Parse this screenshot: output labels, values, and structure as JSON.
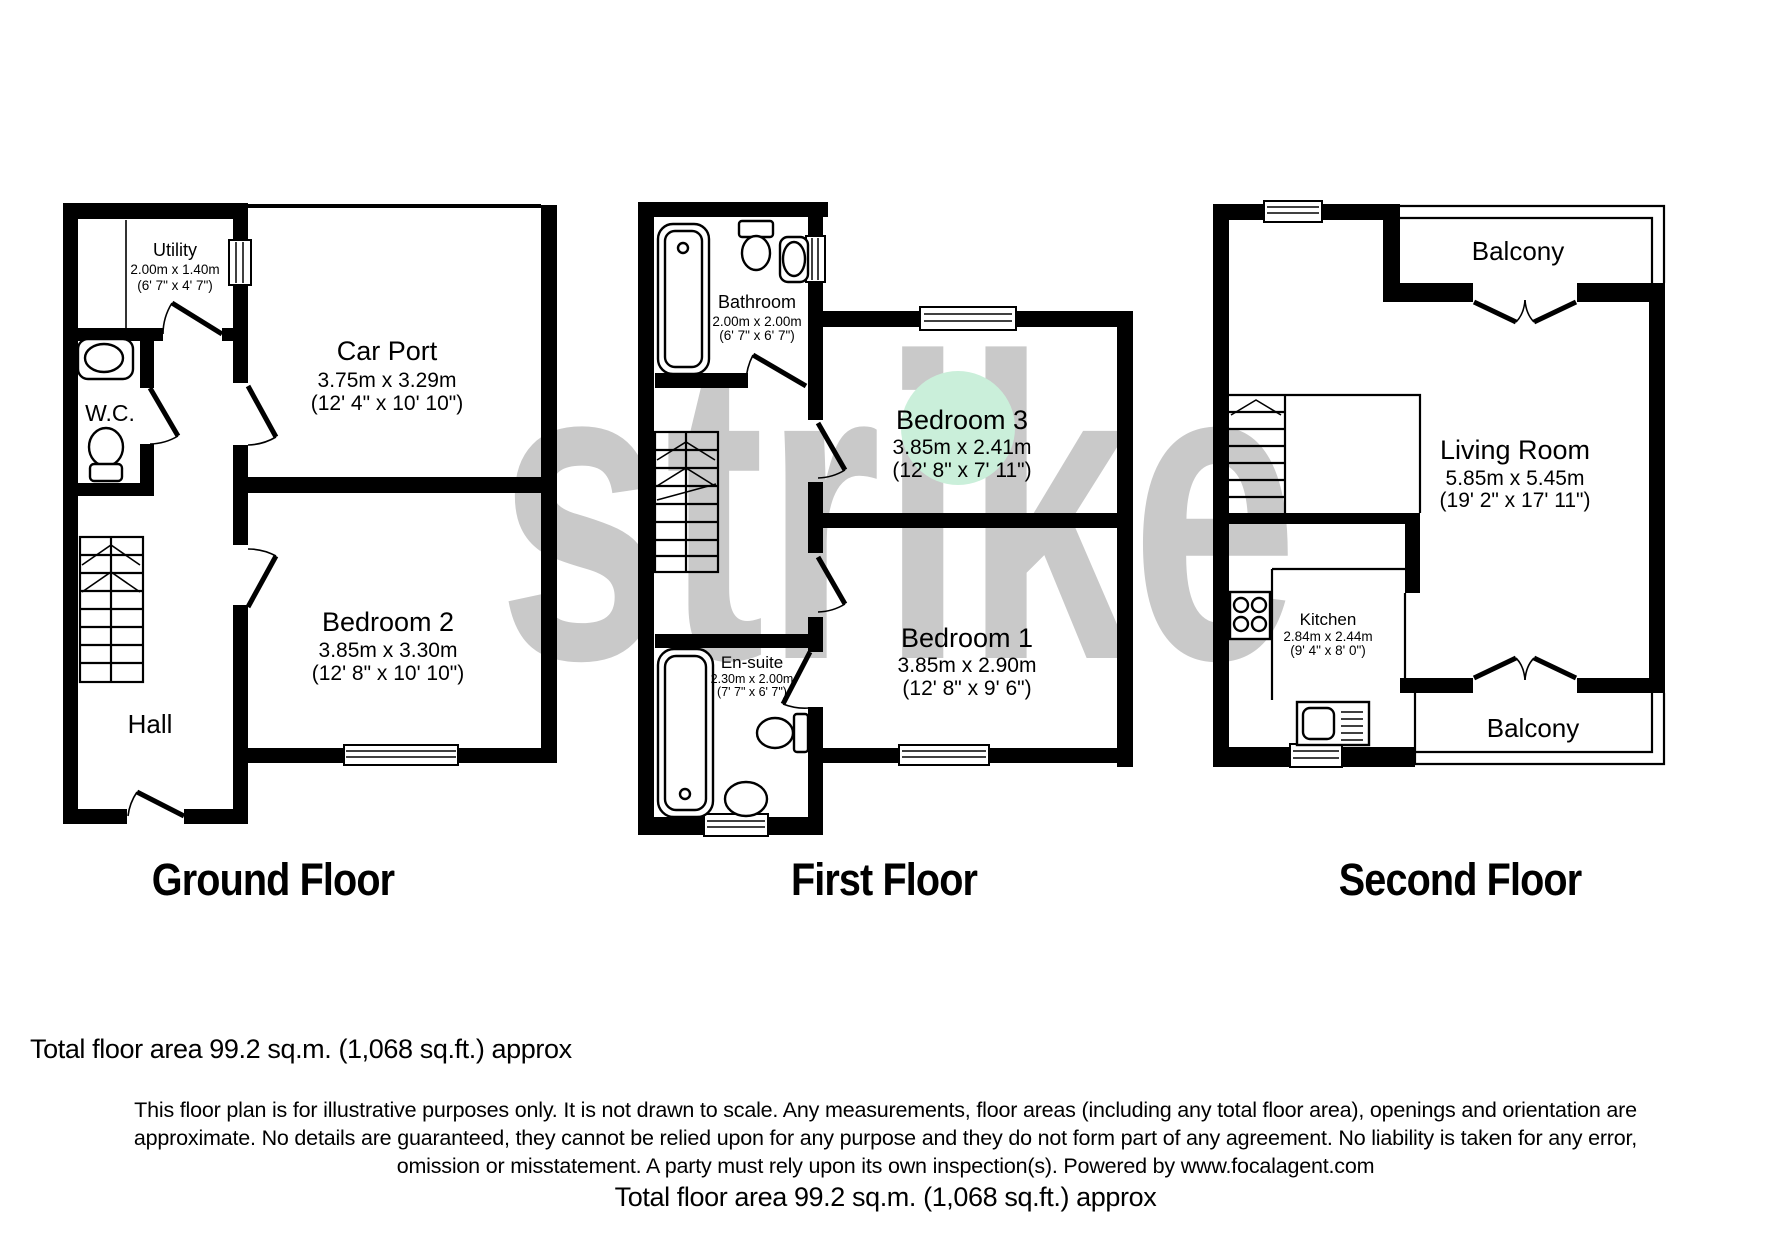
{
  "watermark": "strike",
  "ground_floor": {
    "title": "Ground Floor",
    "utility": {
      "name": "Utility",
      "size_m": "2.00m x 1.40m",
      "size_ft": "(6' 7\" x 4' 7\")"
    },
    "car_port": {
      "name": "Car Port",
      "size_m": "3.75m x 3.29m",
      "size_ft": "(12' 4\" x 10' 10\")"
    },
    "wc": {
      "name": "W.C."
    },
    "bedroom2": {
      "name": "Bedroom 2",
      "size_m": "3.85m x 3.30m",
      "size_ft": "(12' 8\" x 10' 10\")"
    },
    "hall": {
      "name": "Hall"
    }
  },
  "first_floor": {
    "title": "First Floor",
    "bathroom": {
      "name": "Bathroom",
      "size_m": "2.00m x 2.00m",
      "size_ft": "(6' 7\" x 6' 7\")"
    },
    "bedroom3": {
      "name": "Bedroom 3",
      "size_m": "3.85m x 2.41m",
      "size_ft": "(12' 8\" x 7' 11\")"
    },
    "ensuite": {
      "name": "En-suite",
      "size_m": "2.30m x 2.00m",
      "size_ft": "(7' 7\" x 6' 7\")"
    },
    "bedroom1": {
      "name": "Bedroom 1",
      "size_m": "3.85m x 2.90m",
      "size_ft": "(12' 8\" x 9' 6\")"
    }
  },
  "second_floor": {
    "title": "Second Floor",
    "balcony_top": {
      "name": "Balcony"
    },
    "living_room": {
      "name": "Living Room",
      "size_m": "5.85m x 5.45m",
      "size_ft": "(19' 2\" x 17' 11\")"
    },
    "kitchen": {
      "name": "Kitchen",
      "size_m": "2.84m x 2.44m",
      "size_ft": "(9' 4\" x 8' 0\")"
    },
    "balcony_bottom": {
      "name": "Balcony"
    }
  },
  "footer": {
    "total_area_top": "Total floor area 99.2 sq.m. (1,068 sq.ft.) approx",
    "disclaimer_line1": "This floor plan is for illustrative purposes only. It is not drawn to scale. Any measurements, floor areas (including any total floor area), openings and orientation are",
    "disclaimer_line2": "approximate. No details are guaranteed, they cannot be relied upon for any purpose and they do not form part of any agreement. No liability is taken for any error,",
    "disclaimer_line3": "omission or misstatement. A party must rely upon its own inspection(s). Powered by www.focalagent.com",
    "total_area_bottom": "Total floor area 99.2 sq.m. (1,068 sq.ft.) approx"
  },
  "colors": {
    "wall": "#000000",
    "watermark": "#c9c9c9",
    "room_highlight": "#caefda"
  }
}
